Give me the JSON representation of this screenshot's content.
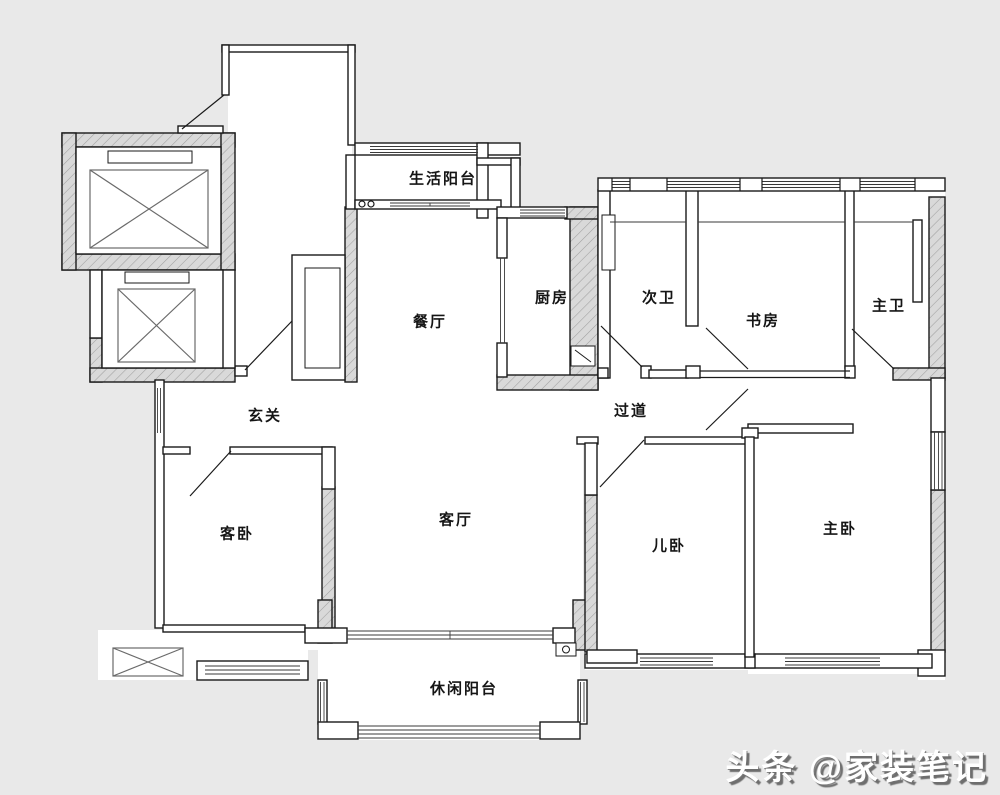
{
  "plan": {
    "type": "apartment-floor-plan",
    "rooms": [
      {
        "id": "living-balcony",
        "label": "生活阳台"
      },
      {
        "id": "kitchen",
        "label": "厨房"
      },
      {
        "id": "second-bathroom",
        "label": "次卫"
      },
      {
        "id": "study",
        "label": "书房"
      },
      {
        "id": "master-bathroom",
        "label": "主卫"
      },
      {
        "id": "dining-room",
        "label": "餐厅"
      },
      {
        "id": "entrance",
        "label": "玄关"
      },
      {
        "id": "hallway",
        "label": "过道"
      },
      {
        "id": "guest-bedroom",
        "label": "客卧"
      },
      {
        "id": "living-room",
        "label": "客厅"
      },
      {
        "id": "kids-bedroom",
        "label": "儿卧"
      },
      {
        "id": "master-bedroom",
        "label": "主卧"
      },
      {
        "id": "leisure-balcony",
        "label": "休闲阳台"
      }
    ],
    "colors": {
      "background": "#e9e9e9",
      "interior": "#ffffff",
      "wall_line": "#1a1a1a",
      "hatch_fill": "#d9d9d9",
      "hatch_line": "#a0a0a0"
    }
  },
  "watermark": {
    "text": "头条 @家装笔记",
    "color": "#ffffff",
    "shadow": "#6e6e6e"
  }
}
